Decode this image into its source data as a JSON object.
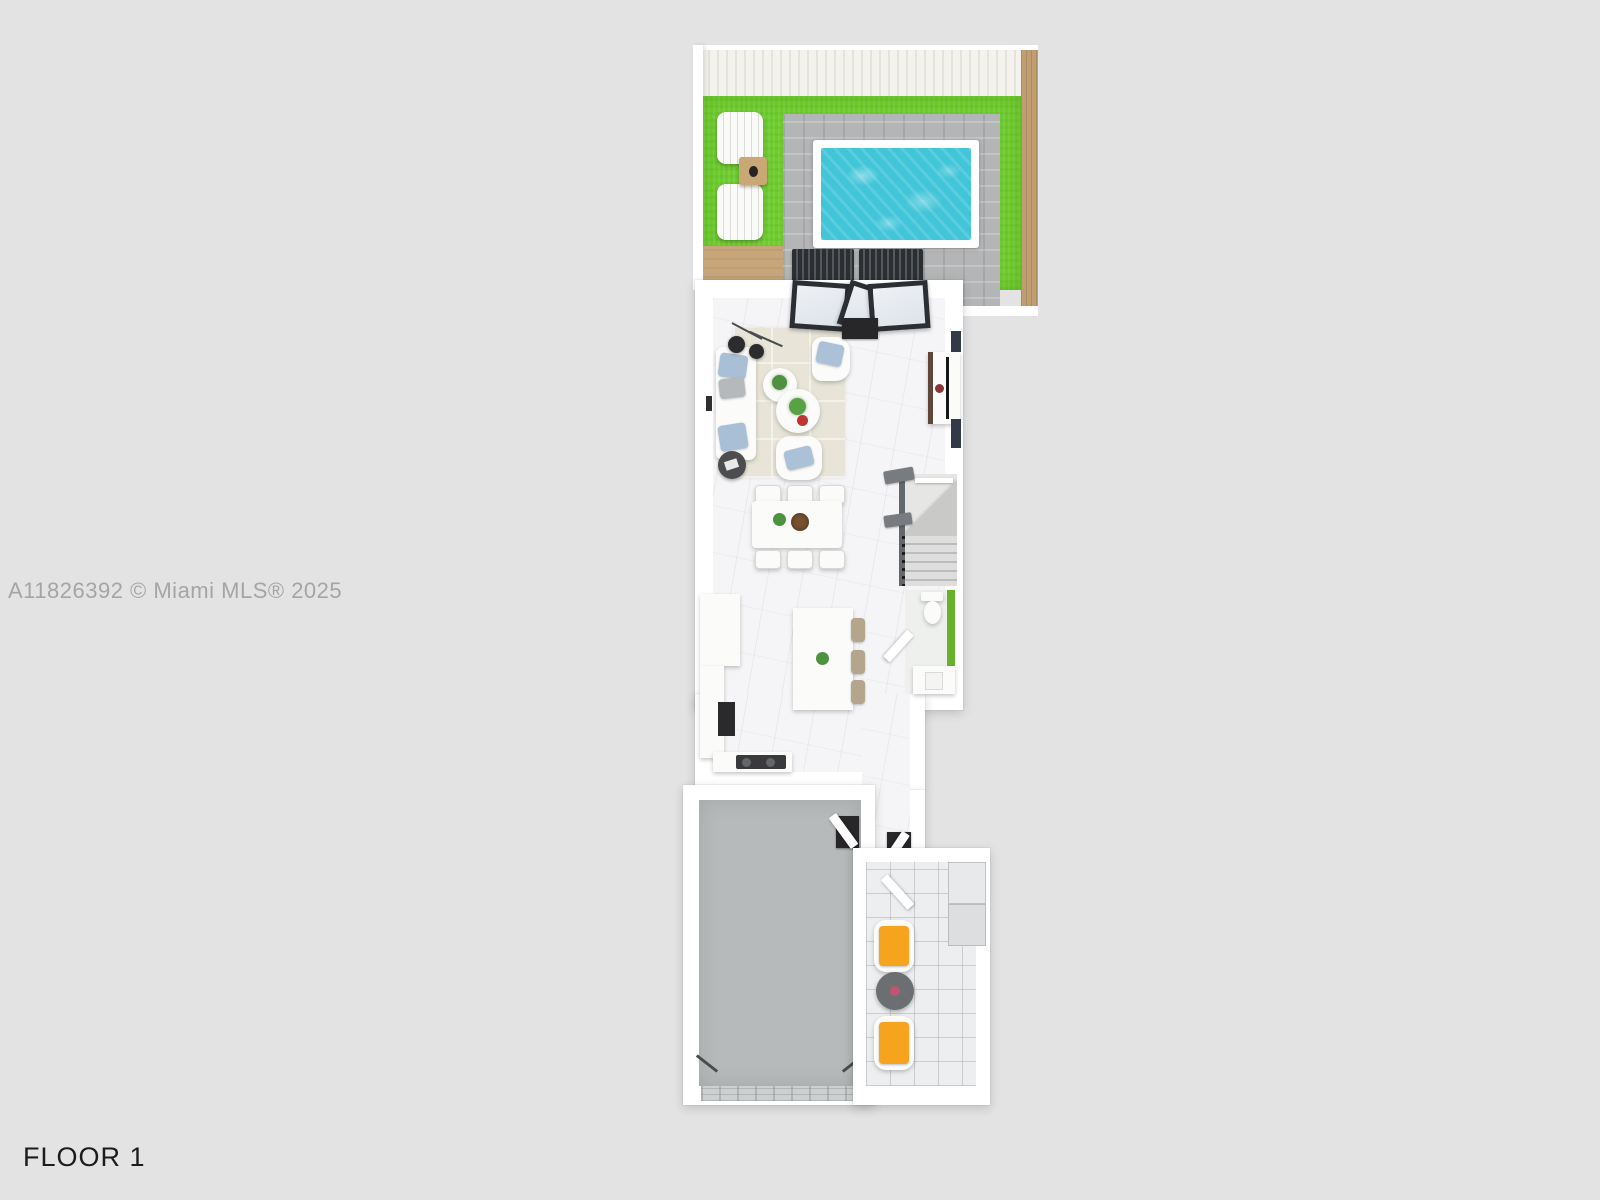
{
  "watermark": {
    "text": "A11826392 © Miami MLS® 2025",
    "color": "#a5a5a7"
  },
  "floor_label": {
    "text": "FLOOR 1",
    "color": "#1c1c1c"
  },
  "plan": {
    "type": "3d-floorplan-render",
    "rooms": [
      "backyard-pool-area",
      "living-room",
      "dining-area",
      "kitchen",
      "stairs",
      "powder-room",
      "hallway",
      "garage",
      "entry-foyer"
    ],
    "outdoor_items": [
      "wood-deck",
      "lawn",
      "paver-patio",
      "swimming-pool",
      "adirondack-chair",
      "adirondack-chair",
      "outdoor-side-table",
      "patio-chair",
      "patio-chair",
      "privacy-fence",
      "sand-path"
    ],
    "indoor_items": [
      "sofa",
      "arc-floor-lamp",
      "armchair",
      "armchair",
      "coffee-table",
      "coffee-table",
      "side-table",
      "tv-console",
      "sliding-glass-doors",
      "door-mat",
      "dining-table",
      "dining-chairs-x6",
      "staircase",
      "toilet",
      "bathroom-vanity",
      "kitchen-island",
      "bar-stools-x3",
      "cooktop",
      "refrigerator",
      "garage-door",
      "accent-chair-orange",
      "accent-chair-orange",
      "round-entry-table",
      "front-door",
      "entry-steps"
    ],
    "colors": {
      "background": "#e3e3e4",
      "wall": "#ffffff",
      "grass": "#6fcc2e",
      "pool_water": "#41c5d8",
      "pool_coping": "#fdfdfd",
      "paver": "#b4b5b6",
      "sand": "#c8a67a",
      "deck_plank": "#f3f2ed",
      "marble_floor": "#f5f5f7",
      "entry_tile": "#eceeef",
      "garage_floor": "#b7baba",
      "bathroom_accent_green": "#68b22b",
      "door_frame_dark": "#2b2e33",
      "cushion_orange": "#f6a31d",
      "pillow_blue": "#a9bfd6",
      "stool_tan": "#b3a68c",
      "rug_beige": "#e8e5d8"
    }
  }
}
